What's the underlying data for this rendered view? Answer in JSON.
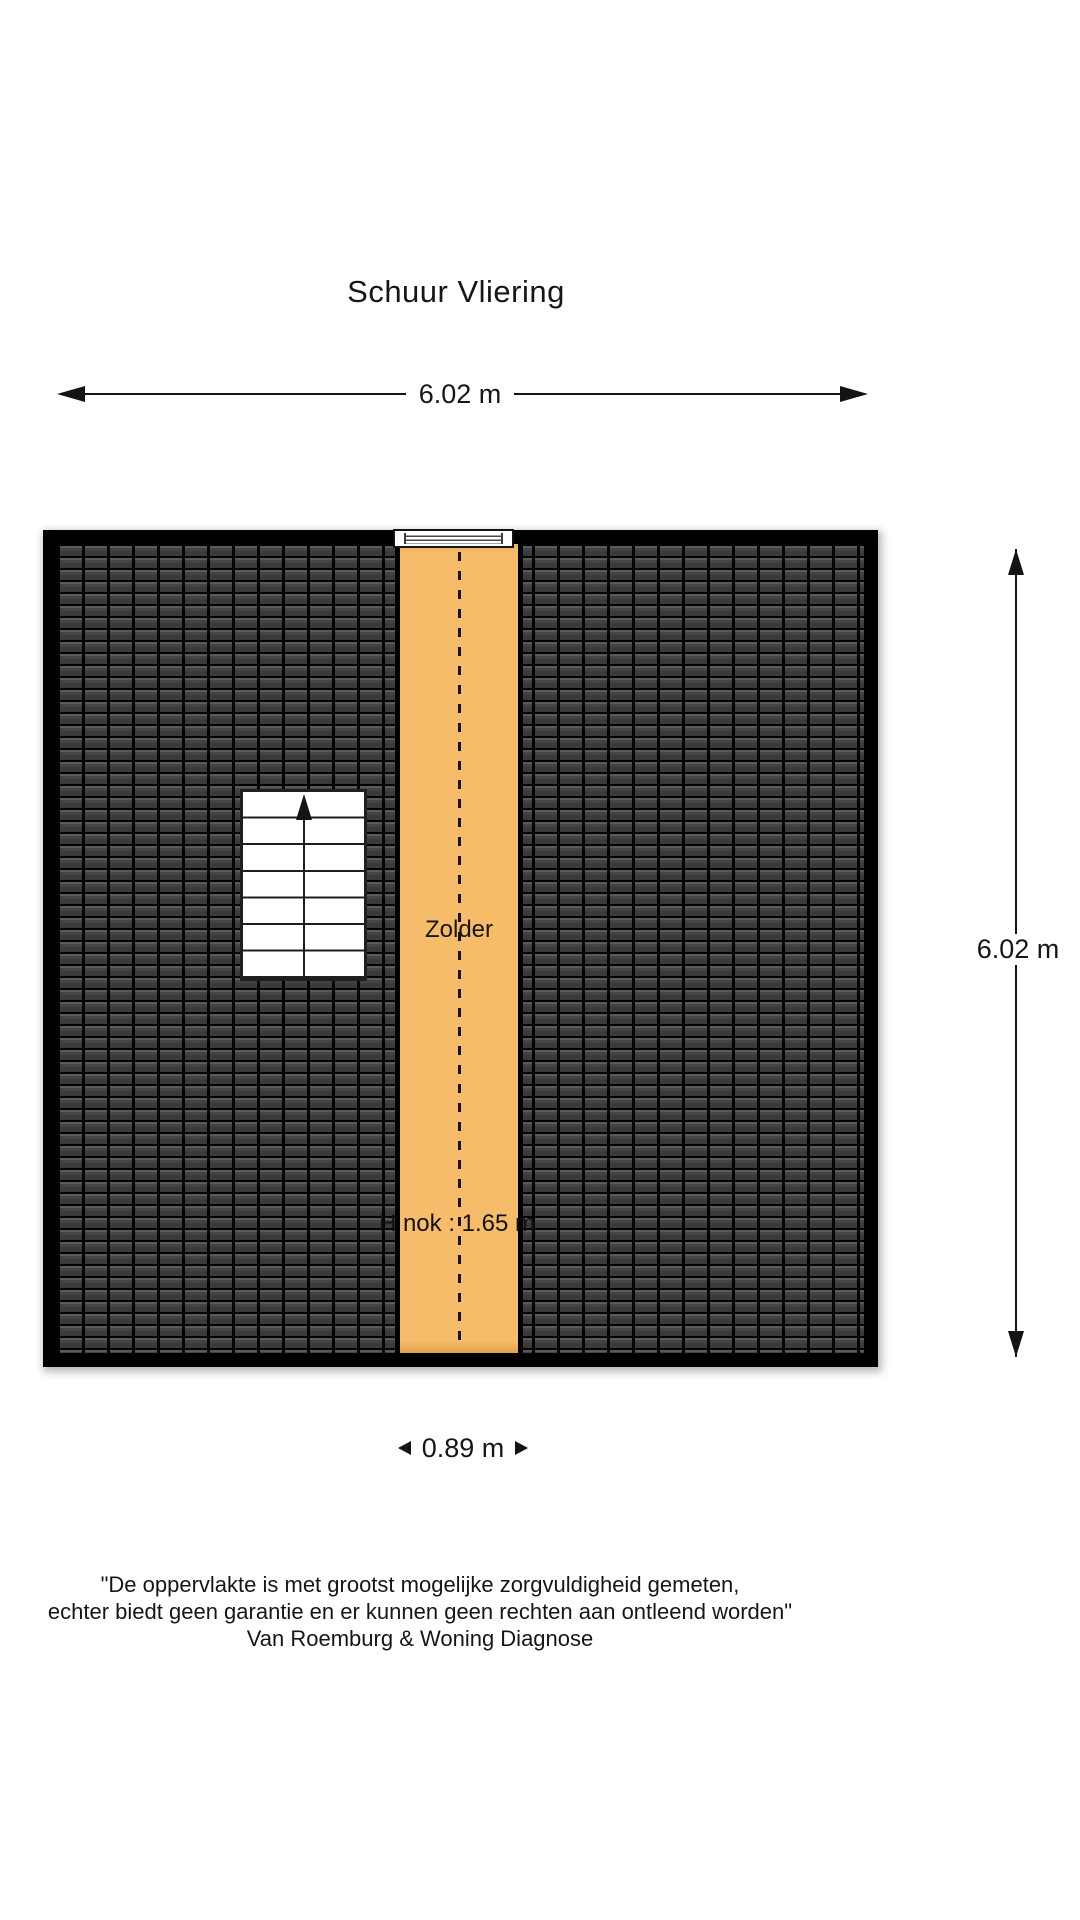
{
  "title": "Schuur Vliering",
  "dimensions": {
    "top": {
      "label": "6.02 m"
    },
    "right": {
      "label": "6.02 m"
    },
    "bottom": {
      "label": "0.89 m"
    }
  },
  "plan": {
    "room_label": "Zolder",
    "ridge_height_label": "H nok : 1.65 m"
  },
  "colors": {
    "floor": "#f6bc69",
    "roof_tile": "#3a3a3a",
    "plan_border": "#000000",
    "line": "#141414"
  },
  "disclaimer": {
    "line1": "\"De oppervlakte is met grootst mogelijke zorgvuldigheid gemeten,",
    "line2": "echter biedt geen garantie en er kunnen geen rechten aan ontleend worden\"",
    "line3": "Van Roemburg & Woning Diagnose"
  }
}
